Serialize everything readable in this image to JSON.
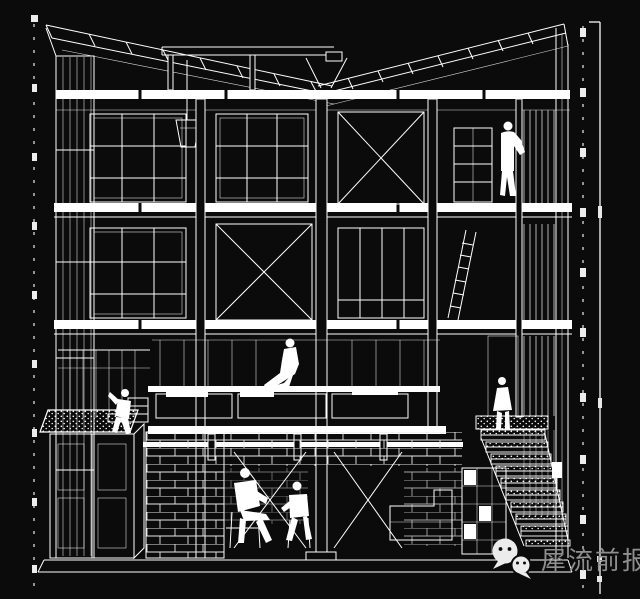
{
  "canvas": {
    "width": 640,
    "height": 599,
    "background_color": "#0b0b0b",
    "line_color": "#ffffff"
  },
  "drawing": {
    "type": "architectural-sectional-perspective",
    "style": "white wireframe line art on black background",
    "elements": [
      "sloped roof joists meeting at a central valley",
      "hanging bucket under roof",
      "three white floor slabs",
      "cross-braced structural bays",
      "gridded window partitions",
      "left stud wall",
      "right slatted wall",
      "leaning ladder",
      "shelving unit",
      "central platform with cushions",
      "long suspended bench beam",
      "gravel planter and cabinet at lower left",
      "masonry basement walls",
      "basement duct",
      "exterior stair with stippled treads",
      "glass-block wall under stair",
      "six human figures",
      "vertical reference lines with tick marks on left and right edges",
      "right-hand scale bar"
    ],
    "figure_count": 6
  },
  "watermark": {
    "icon": "wechat-logo",
    "icon_color": "#ececec",
    "text": "犀流前报",
    "text_color": "#8f8f8f"
  }
}
